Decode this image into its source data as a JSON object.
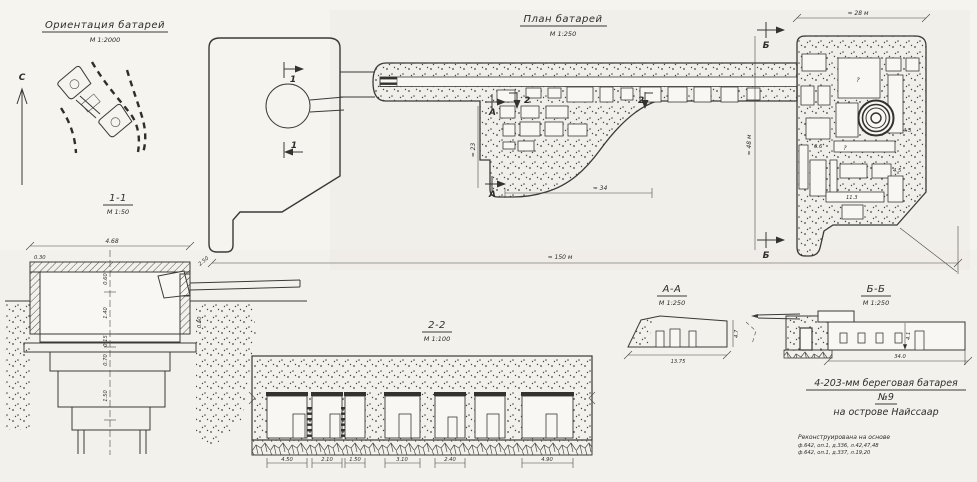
{
  "page": {
    "bg": "#f6f4ef",
    "ink": "#3b3a37"
  },
  "orientation": {
    "title": "Ориентация батарей",
    "scale": "М 1:2000",
    "north": "С"
  },
  "plan": {
    "title": "План батарей",
    "scale": "М 1:250",
    "marker_1": "1",
    "marker_2": "2",
    "marker_a": "А",
    "marker_b": "Б",
    "dim_top": "≈ 28 м",
    "dim_side": "≈ 48 м",
    "dim_total": "≈ 150 м",
    "dim_rooms_w": "≈ 34",
    "dim_rooms_h": "≈ 23",
    "room_query": "?",
    "small_dims": {
      "d1": "6.6",
      "d2": "4.5",
      "d3": "11.3",
      "d4": "4.3"
    }
  },
  "section_1_1": {
    "title": "1-1",
    "scale": "М 1:50",
    "dim_width": "4.68",
    "dim_wall": "0.30",
    "dim_parapet": "2.50",
    "dim_wall_r": "0.50",
    "chain": {
      "c1": "0.60",
      "c2": "1.40",
      "c3": "0.15",
      "c4": "0.70",
      "c5": "1.50"
    }
  },
  "section_2_2": {
    "title": "2-2",
    "scale": "М 1:100",
    "dims": {
      "d1": "4.50",
      "d2": "2.10",
      "d3": "1.50",
      "d4": "3.10",
      "d5": "2.40",
      "d6": "4.90"
    }
  },
  "section_a_a": {
    "title": "А-А",
    "scale": "М 1:250",
    "dim_width": "13.75",
    "dim_height": "4.7"
  },
  "section_b_b": {
    "title": "Б-Б",
    "scale": "М 1:250",
    "dim_width": "34.0",
    "dim_height": "4.1"
  },
  "title_block": {
    "line1": "4-203-мм береговая батарея",
    "line2": "№9",
    "line3": "на острове Найссаар"
  },
  "notes": {
    "header": "Реконструирована на основе",
    "ref1": "ф.642, оп.1, д.336, л.42,47,48",
    "ref2": "ф.642, оп.1, д.337, л.19,20"
  }
}
